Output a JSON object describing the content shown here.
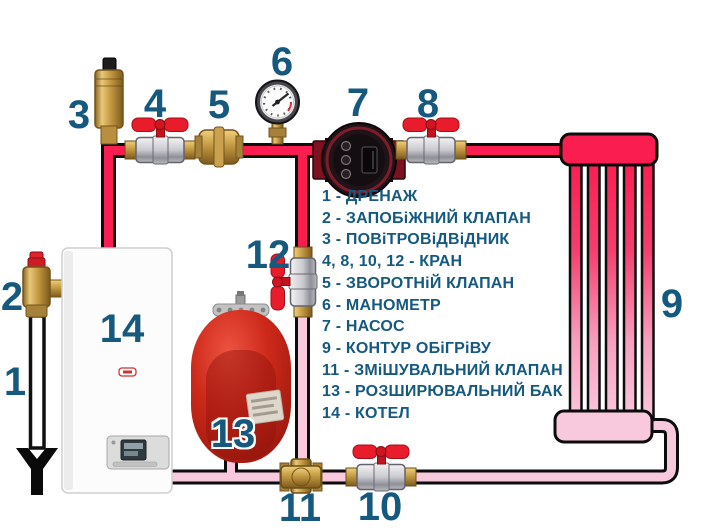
{
  "diagram": {
    "component_labels": {
      "n1": "1",
      "n2": "2",
      "n3": "3",
      "n4": "4",
      "n5": "5",
      "n6": "6",
      "n7": "7",
      "n8": "8",
      "n9": "9",
      "n10": "10",
      "n11": "11",
      "n12": "12",
      "n13": "13",
      "n14": "14"
    },
    "legend": {
      "items": [
        "1 - ДРЕНАЖ",
        "2 - ЗАПОБіЖНИЙ КЛАПАН",
        "3 - ПОВіТРОВіДВіДНИК",
        "4, 8, 10, 12 - КРАН",
        "5 - ЗВОРОТНіЙ КЛАПАН",
        "6 - МАНОМЕТР",
        "7 - НАСОС",
        "9 - КОНТУР ОБіГРіВУ",
        "11 - ЗМіШУВАЛЬНИЙ КЛАПАН",
        "13 - РОЗШИРЮВАЛЬНИЙ БАК",
        "14 - КОТЕЛ"
      ]
    },
    "colors": {
      "label_blue": "#15597f",
      "supply_pipe": "#fa1d4f",
      "return_pipe": "#f8c8dd",
      "valve_red": "#e81c2a",
      "tank_red": "#c02014"
    }
  }
}
